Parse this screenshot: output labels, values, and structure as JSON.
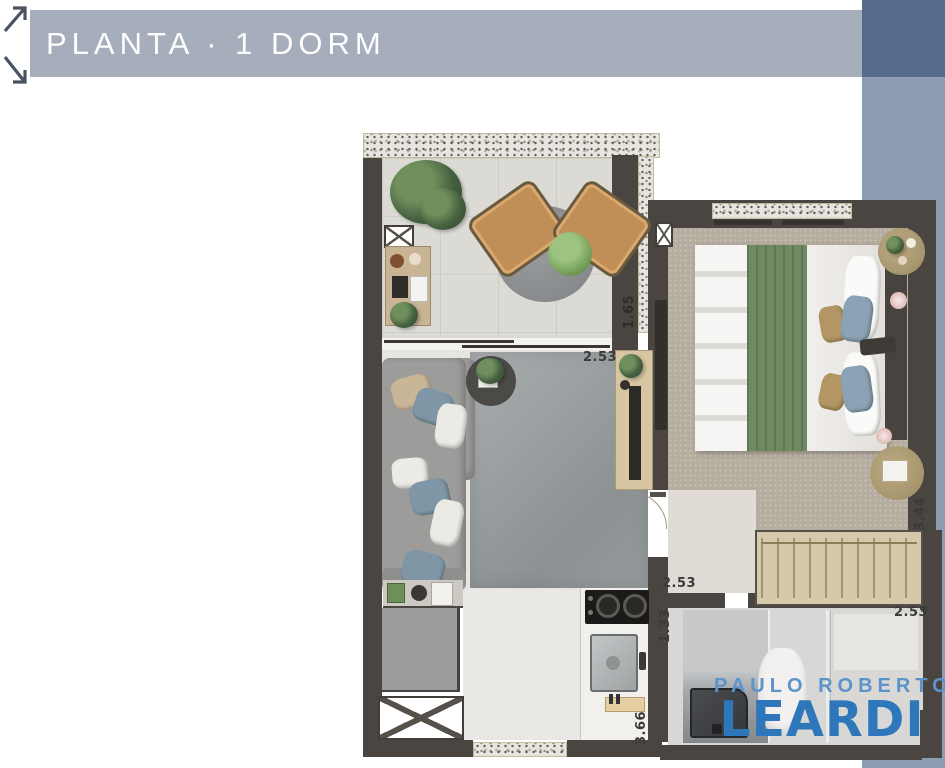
{
  "header": {
    "title": "PLANTA · 1 DORM",
    "icon": "expand-diagonal-arrows"
  },
  "plan": {
    "type": "apartment-floor-plan-1-bedroom",
    "dimensions": [
      {
        "value": "2.53",
        "location": "living-room-top",
        "orientation": "horizontal"
      },
      {
        "value": "1.65",
        "location": "balcony-right",
        "orientation": "vertical"
      },
      {
        "value": "3.44",
        "location": "bedroom-right",
        "orientation": "vertical"
      },
      {
        "value": "2.53",
        "location": "hallway-bottom",
        "orientation": "horizontal"
      },
      {
        "value": "1.33",
        "location": "bathroom-entry",
        "orientation": "vertical"
      },
      {
        "value": "3.66",
        "location": "kitchen-right",
        "orientation": "vertical"
      },
      {
        "value": "2.53",
        "location": "bathroom-right",
        "orientation": "horizontal"
      }
    ]
  },
  "logo": {
    "line1": "PAULO ROBERTO",
    "line2": "LEARDI"
  },
  "colors": {
    "header_bar": "#a6aebc",
    "sidebar_dark": "#566b8b",
    "sidebar_light": "#8b9cb3",
    "wall": "#4a4540",
    "logo_primary": "#2e77ba",
    "logo_secondary": "#5b94cb",
    "granite_trim": "#c2ba96"
  }
}
